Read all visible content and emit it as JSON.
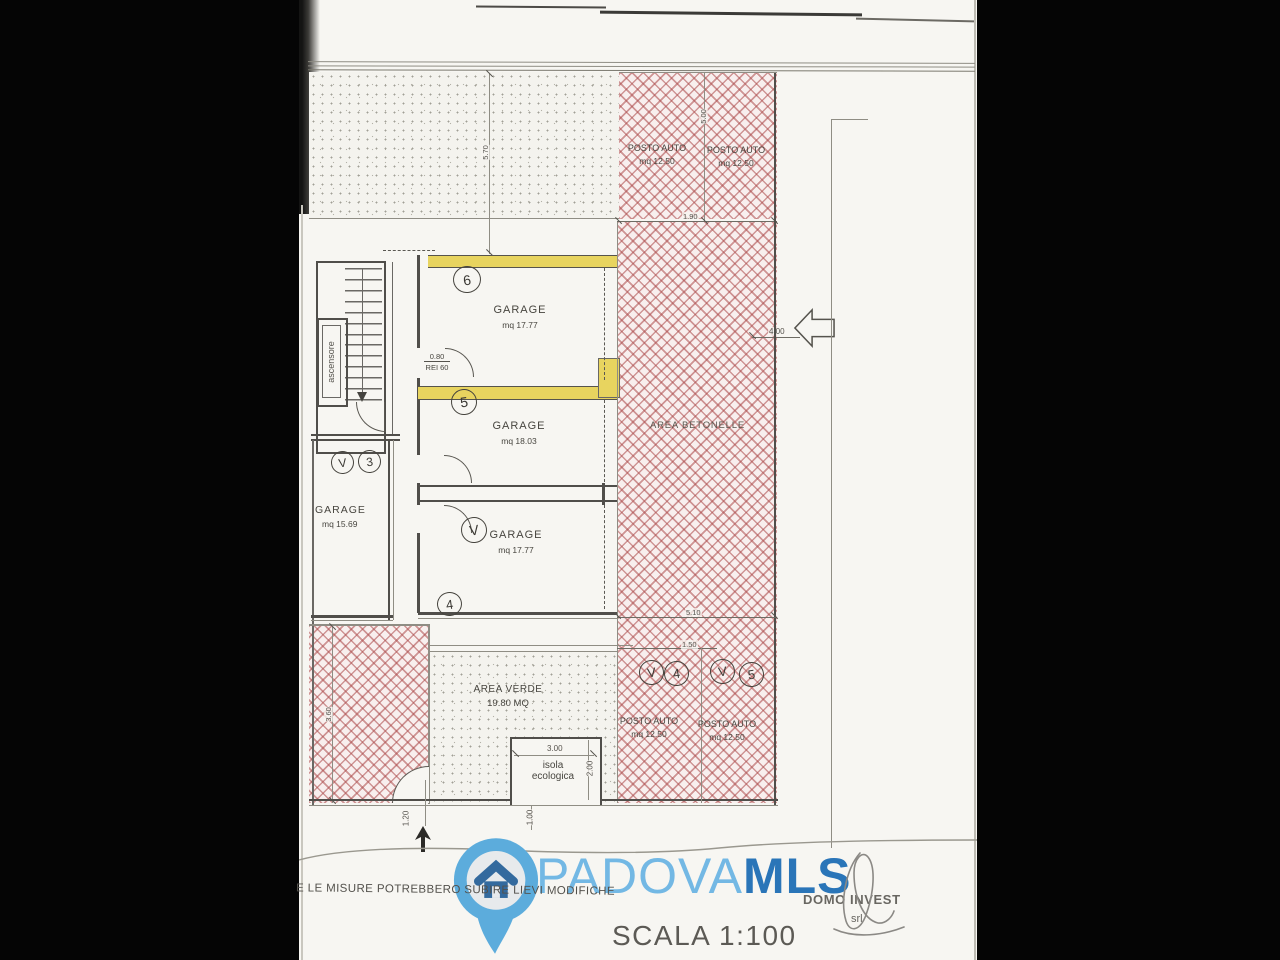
{
  "watermark": {
    "city": "PADOVA",
    "org": "MLS"
  },
  "footer": {
    "disclaimer": "E LE MISURE POTREBBERO SUBIRE LIEVI MODIFICHE",
    "company": "DOMO INVEST",
    "company_suffix": "srl",
    "scale": "SCALA 1:100"
  },
  "rooms": {
    "garage6": {
      "name": "GARAGE",
      "area": "mq 17.77"
    },
    "garage5": {
      "name": "GARAGE",
      "area": "mq 18.03"
    },
    "garage4": {
      "name": "GARAGE",
      "area": "mq 17.77"
    },
    "garage3": {
      "name": "GARAGE",
      "area": "mq 15.69"
    },
    "parking_top_left": {
      "name": "POSTO AUTO",
      "area": "mq 12.50"
    },
    "parking_top_right": {
      "name": "POSTO AUTO",
      "area": "mq 12.50"
    },
    "parking_bottom_left": {
      "name": "POSTO AUTO",
      "area": "mq 12.50"
    },
    "parking_bottom_right": {
      "name": "POSTO AUTO",
      "area": "mq 12.50"
    },
    "area_betonelle": "AREA BETONELLE",
    "area_verde": {
      "name": "AREA VERDE",
      "area": "19.80 MQ"
    },
    "isola_ecologica": {
      "line1": "isola",
      "line2": "ecologica"
    },
    "ascensore": "ascensore"
  },
  "unit_marks": {
    "garage6": "6",
    "garage5": "5",
    "garage4_v": "V",
    "garage4": "4",
    "garage3_v": "V",
    "garage3": "3",
    "parking4_v": "V",
    "parking4": "4",
    "parking5_v": "V",
    "parking5": "5"
  },
  "dimensions": {
    "top_depth": "5.70",
    "top_width": "1.90",
    "top_length": "5.00",
    "side_width": "4.00",
    "bottom_length": "5.10",
    "bottom_width": "1.50",
    "isola_width": "3.00",
    "isola_depth": "2.00",
    "gate_width": "1.00",
    "entry_width": "1.20",
    "left_depth": "3.60",
    "door_width": "0.80",
    "door_rating": "REI 60"
  },
  "colors": {
    "hatch_red": "#b24e4e",
    "highlight_yellow": "#e8d45f",
    "pin_blue": "#5CACDC",
    "padova_blue": "#6AB4E4",
    "mls_blue": "#1B6CB4"
  }
}
